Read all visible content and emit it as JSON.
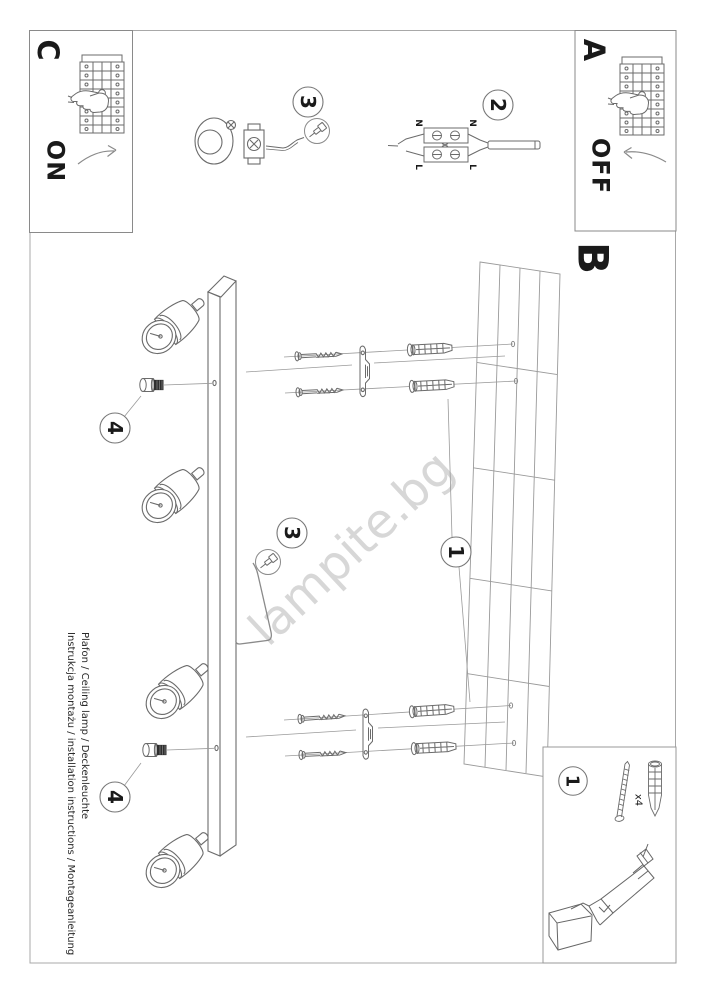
{
  "doc": {
    "sections": {
      "a": "A",
      "b": "B",
      "c": "C"
    },
    "power": {
      "on": "ON",
      "off": "OFF"
    },
    "steps": {
      "s1": "1",
      "s2": "2",
      "s3": "3",
      "s4": "4"
    },
    "terminals": {
      "n": "N",
      "l": "L"
    },
    "hardware_qty": "x4",
    "watermark": "lampite.bg",
    "footer_line1": "Instrukcja montażu / installation instructions / Montageanleitung",
    "footer_line2": "Plafon / Ceiling lamp / Deckenleuchte",
    "colors": {
      "line": "#6b6b6b",
      "leader": "#9a9a9a",
      "text": "#1a1a1a",
      "watermark": "#d7d7d7"
    }
  }
}
